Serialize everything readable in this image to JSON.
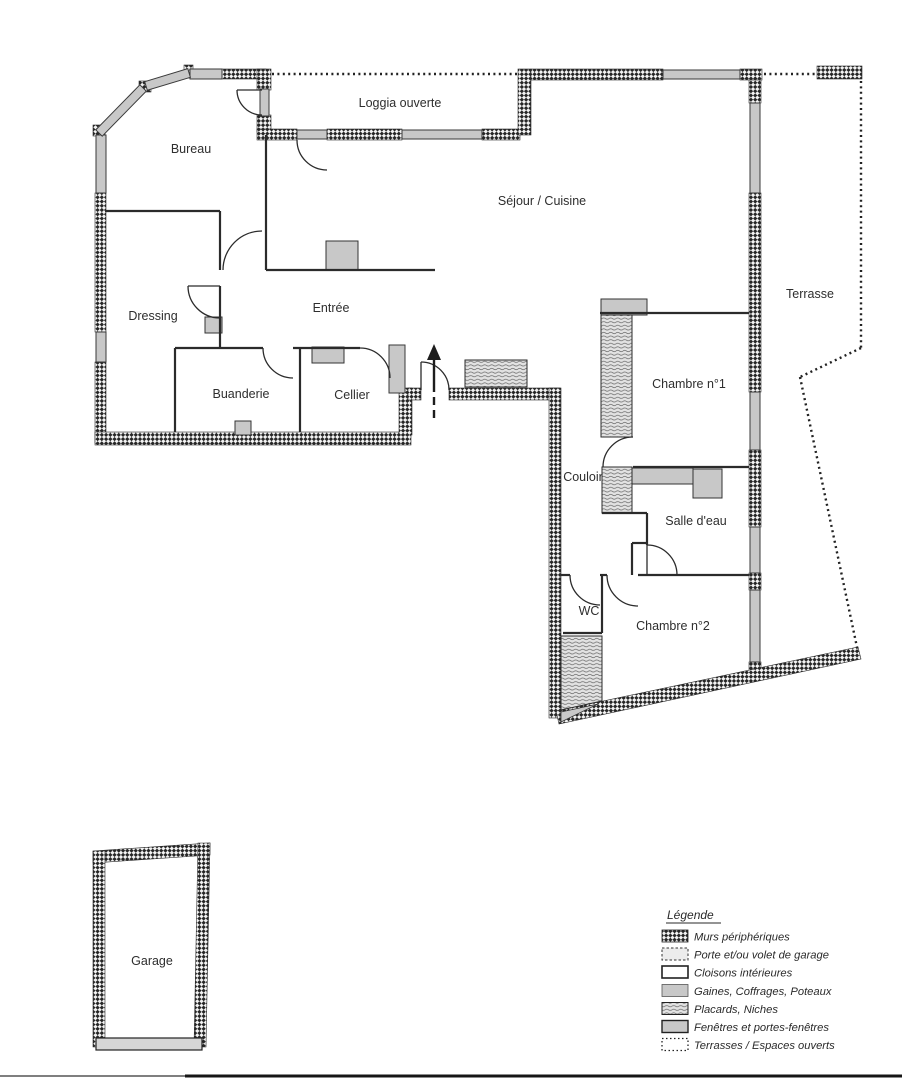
{
  "document": {
    "type": "floor-plan-scan",
    "language": "fr"
  },
  "plan": {
    "rooms": [
      {
        "id": "bureau",
        "label": "Bureau"
      },
      {
        "id": "loggia",
        "label": "Loggia ouverte"
      },
      {
        "id": "sejour",
        "label": "Séjour / Cuisine"
      },
      {
        "id": "dressing",
        "label": "Dressing"
      },
      {
        "id": "entree",
        "label": "Entrée"
      },
      {
        "id": "buanderie",
        "label": "Buanderie"
      },
      {
        "id": "cellier",
        "label": "Cellier"
      },
      {
        "id": "terrasse",
        "label": "Terrasse"
      },
      {
        "id": "chambre1",
        "label": "Chambre n°1"
      },
      {
        "id": "couloir",
        "label": "Couloir"
      },
      {
        "id": "salle_eau",
        "label": "Salle d'eau"
      },
      {
        "id": "wc",
        "label": "WC"
      },
      {
        "id": "chambre2",
        "label": "Chambre n°2"
      },
      {
        "id": "garage",
        "label": "Garage"
      }
    ]
  },
  "legend": {
    "title": "Légende",
    "items": [
      {
        "key": "murs",
        "label": "Murs périphériques"
      },
      {
        "key": "porte",
        "label": "Porte et/ou volet de garage"
      },
      {
        "key": "cloisons",
        "label": "Cloisons intérieures"
      },
      {
        "key": "gaines",
        "label": "Gaines, Coffrages, Poteaux"
      },
      {
        "key": "placards",
        "label": "Placards, Niches"
      },
      {
        "key": "fenetres",
        "label": "Fenêtres et portes-fenêtres"
      },
      {
        "key": "terrasses",
        "label": "Terrasses / Espaces ouverts"
      }
    ]
  },
  "colors": {
    "wall_dark": "#262626",
    "window_gray": "#c8c8c8",
    "placard_bg": "#e2e2e2",
    "paper": "#ffffff"
  }
}
